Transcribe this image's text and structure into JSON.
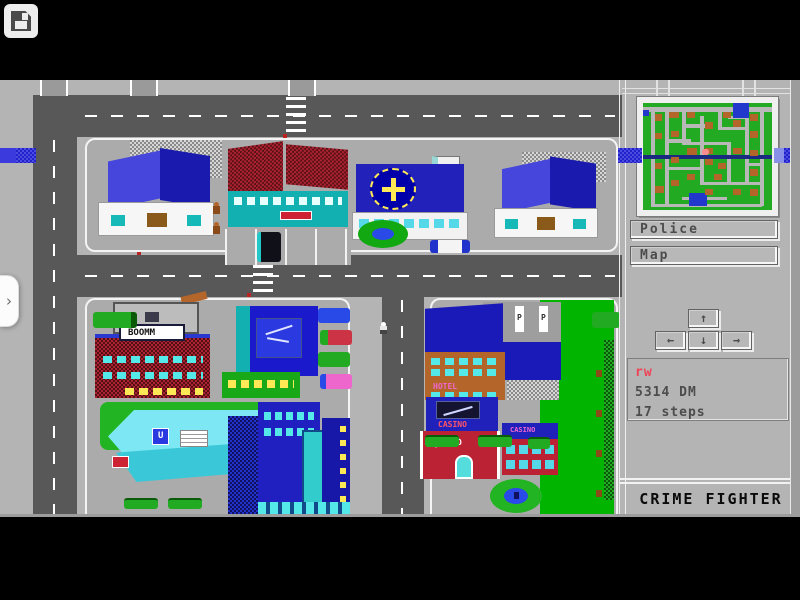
{
  "viewer": {
    "save_icon": "floppy-disk",
    "handle_chevron": "›"
  },
  "game": {
    "title": "CRIME FIGHTER",
    "panel": {
      "police_label": "Police",
      "map_label": "Map",
      "dpad": {
        "up": "↑",
        "left": "←",
        "down": "↓",
        "right": "→"
      },
      "status": {
        "line1": "rw",
        "line2": "5314 DM",
        "line3": "17 steps"
      }
    },
    "map_signs": {
      "boomm": "BOOMM",
      "casino": "CASINO",
      "hotel": "HOTEL",
      "parking": "P",
      "u": "U"
    },
    "colors": {
      "screen_gray": "#b4b4b4",
      "street": "#585858",
      "block": "#ababab",
      "stripe_blue": "#2222cc",
      "park_green": "#00b400",
      "status_red": "#ee4455",
      "status_gray": "#4c4c4c"
    },
    "minimap": {
      "colors": {
        "g": "#22aa22",
        "r": "#b8b8b8",
        "b": "#b4662a",
        "u": "#2238cc",
        "l": "#1a2a80",
        "p": "#ff8c8c"
      },
      "rects": [
        {
          "x": 0,
          "y": 4,
          "w": 100,
          "h": 4,
          "c": "r"
        },
        {
          "x": 6,
          "y": 4,
          "w": 3,
          "h": 92,
          "c": "r"
        },
        {
          "x": 17,
          "y": 4,
          "w": 3,
          "h": 60,
          "c": "r"
        },
        {
          "x": 17,
          "y": 34,
          "w": 20,
          "h": 3,
          "c": "r"
        },
        {
          "x": 30,
          "y": 4,
          "w": 3,
          "h": 34,
          "c": "r"
        },
        {
          "x": 30,
          "y": 20,
          "w": 18,
          "h": 3,
          "c": "r"
        },
        {
          "x": 44,
          "y": 12,
          "w": 3,
          "h": 50,
          "c": "r"
        },
        {
          "x": 30,
          "y": 36,
          "w": 35,
          "h": 3,
          "c": "r"
        },
        {
          "x": 58,
          "y": 4,
          "w": 3,
          "h": 20,
          "c": "r"
        },
        {
          "x": 58,
          "y": 22,
          "w": 24,
          "h": 3,
          "c": "r"
        },
        {
          "x": 66,
          "y": 12,
          "w": 16,
          "h": 3,
          "c": "r"
        },
        {
          "x": 79,
          "y": 4,
          "w": 3,
          "h": 72,
          "c": "r"
        },
        {
          "x": 91,
          "y": 4,
          "w": 3,
          "h": 92,
          "c": "r"
        },
        {
          "x": 17,
          "y": 60,
          "w": 30,
          "h": 3,
          "c": "r"
        },
        {
          "x": 17,
          "y": 62,
          "w": 3,
          "h": 34,
          "c": "r"
        },
        {
          "x": 44,
          "y": 74,
          "w": 24,
          "h": 3,
          "c": "r"
        },
        {
          "x": 65,
          "y": 36,
          "w": 3,
          "h": 40,
          "c": "r"
        },
        {
          "x": 65,
          "y": 74,
          "w": 28,
          "h": 3,
          "c": "r"
        },
        {
          "x": 30,
          "y": 88,
          "w": 35,
          "h": 3,
          "c": "r"
        },
        {
          "x": 6,
          "y": 94,
          "w": 86,
          "h": 3,
          "c": "r"
        },
        {
          "x": 44,
          "y": 60,
          "w": 3,
          "h": 16,
          "c": "r"
        },
        {
          "x": 79,
          "y": 56,
          "w": 14,
          "h": 3,
          "c": "r"
        },
        {
          "x": 70,
          "y": 0,
          "w": 12,
          "h": 14,
          "c": "u"
        },
        {
          "x": 36,
          "y": 84,
          "w": 14,
          "h": 12,
          "c": "u"
        },
        {
          "x": 0,
          "y": 7,
          "w": 5,
          "h": 5,
          "c": "u"
        },
        {
          "x": 0,
          "y": 49,
          "w": 100,
          "h": 3,
          "c": "l"
        },
        {
          "x": 9,
          "y": 10,
          "w": 6,
          "h": 7,
          "c": "b"
        },
        {
          "x": 20,
          "y": 8,
          "w": 8,
          "h": 6,
          "c": "b"
        },
        {
          "x": 34,
          "y": 8,
          "w": 6,
          "h": 6,
          "c": "b"
        },
        {
          "x": 62,
          "y": 8,
          "w": 6,
          "h": 6,
          "c": "b"
        },
        {
          "x": 83,
          "y": 10,
          "w": 6,
          "h": 7,
          "c": "b"
        },
        {
          "x": 9,
          "y": 28,
          "w": 6,
          "h": 6,
          "c": "b"
        },
        {
          "x": 22,
          "y": 26,
          "w": 6,
          "h": 6,
          "c": "b"
        },
        {
          "x": 48,
          "y": 18,
          "w": 6,
          "h": 6,
          "c": "b"
        },
        {
          "x": 70,
          "y": 16,
          "w": 6,
          "h": 6,
          "c": "b"
        },
        {
          "x": 83,
          "y": 26,
          "w": 6,
          "h": 7,
          "c": "b"
        },
        {
          "x": 34,
          "y": 42,
          "w": 8,
          "h": 7,
          "c": "b"
        },
        {
          "x": 48,
          "y": 42,
          "w": 6,
          "h": 6,
          "c": "b"
        },
        {
          "x": 70,
          "y": 42,
          "w": 7,
          "h": 6,
          "c": "b"
        },
        {
          "x": 83,
          "y": 44,
          "w": 6,
          "h": 6,
          "c": "b"
        },
        {
          "x": 9,
          "y": 56,
          "w": 6,
          "h": 6,
          "c": "b"
        },
        {
          "x": 22,
          "y": 50,
          "w": 6,
          "h": 6,
          "c": "b"
        },
        {
          "x": 48,
          "y": 52,
          "w": 6,
          "h": 6,
          "c": "b"
        },
        {
          "x": 58,
          "y": 56,
          "w": 6,
          "h": 6,
          "c": "b"
        },
        {
          "x": 83,
          "y": 62,
          "w": 6,
          "h": 6,
          "c": "b"
        },
        {
          "x": 9,
          "y": 78,
          "w": 7,
          "h": 6,
          "c": "b"
        },
        {
          "x": 22,
          "y": 72,
          "w": 6,
          "h": 6,
          "c": "b"
        },
        {
          "x": 34,
          "y": 66,
          "w": 6,
          "h": 6,
          "c": "b"
        },
        {
          "x": 48,
          "y": 80,
          "w": 6,
          "h": 6,
          "c": "b"
        },
        {
          "x": 70,
          "y": 80,
          "w": 6,
          "h": 6,
          "c": "b"
        },
        {
          "x": 83,
          "y": 80,
          "w": 6,
          "h": 7,
          "c": "b"
        },
        {
          "x": 55,
          "y": 66,
          "w": 6,
          "h": 6,
          "c": "b"
        },
        {
          "x": 46,
          "y": 43,
          "w": 5,
          "h": 6,
          "c": "p"
        }
      ]
    }
  }
}
